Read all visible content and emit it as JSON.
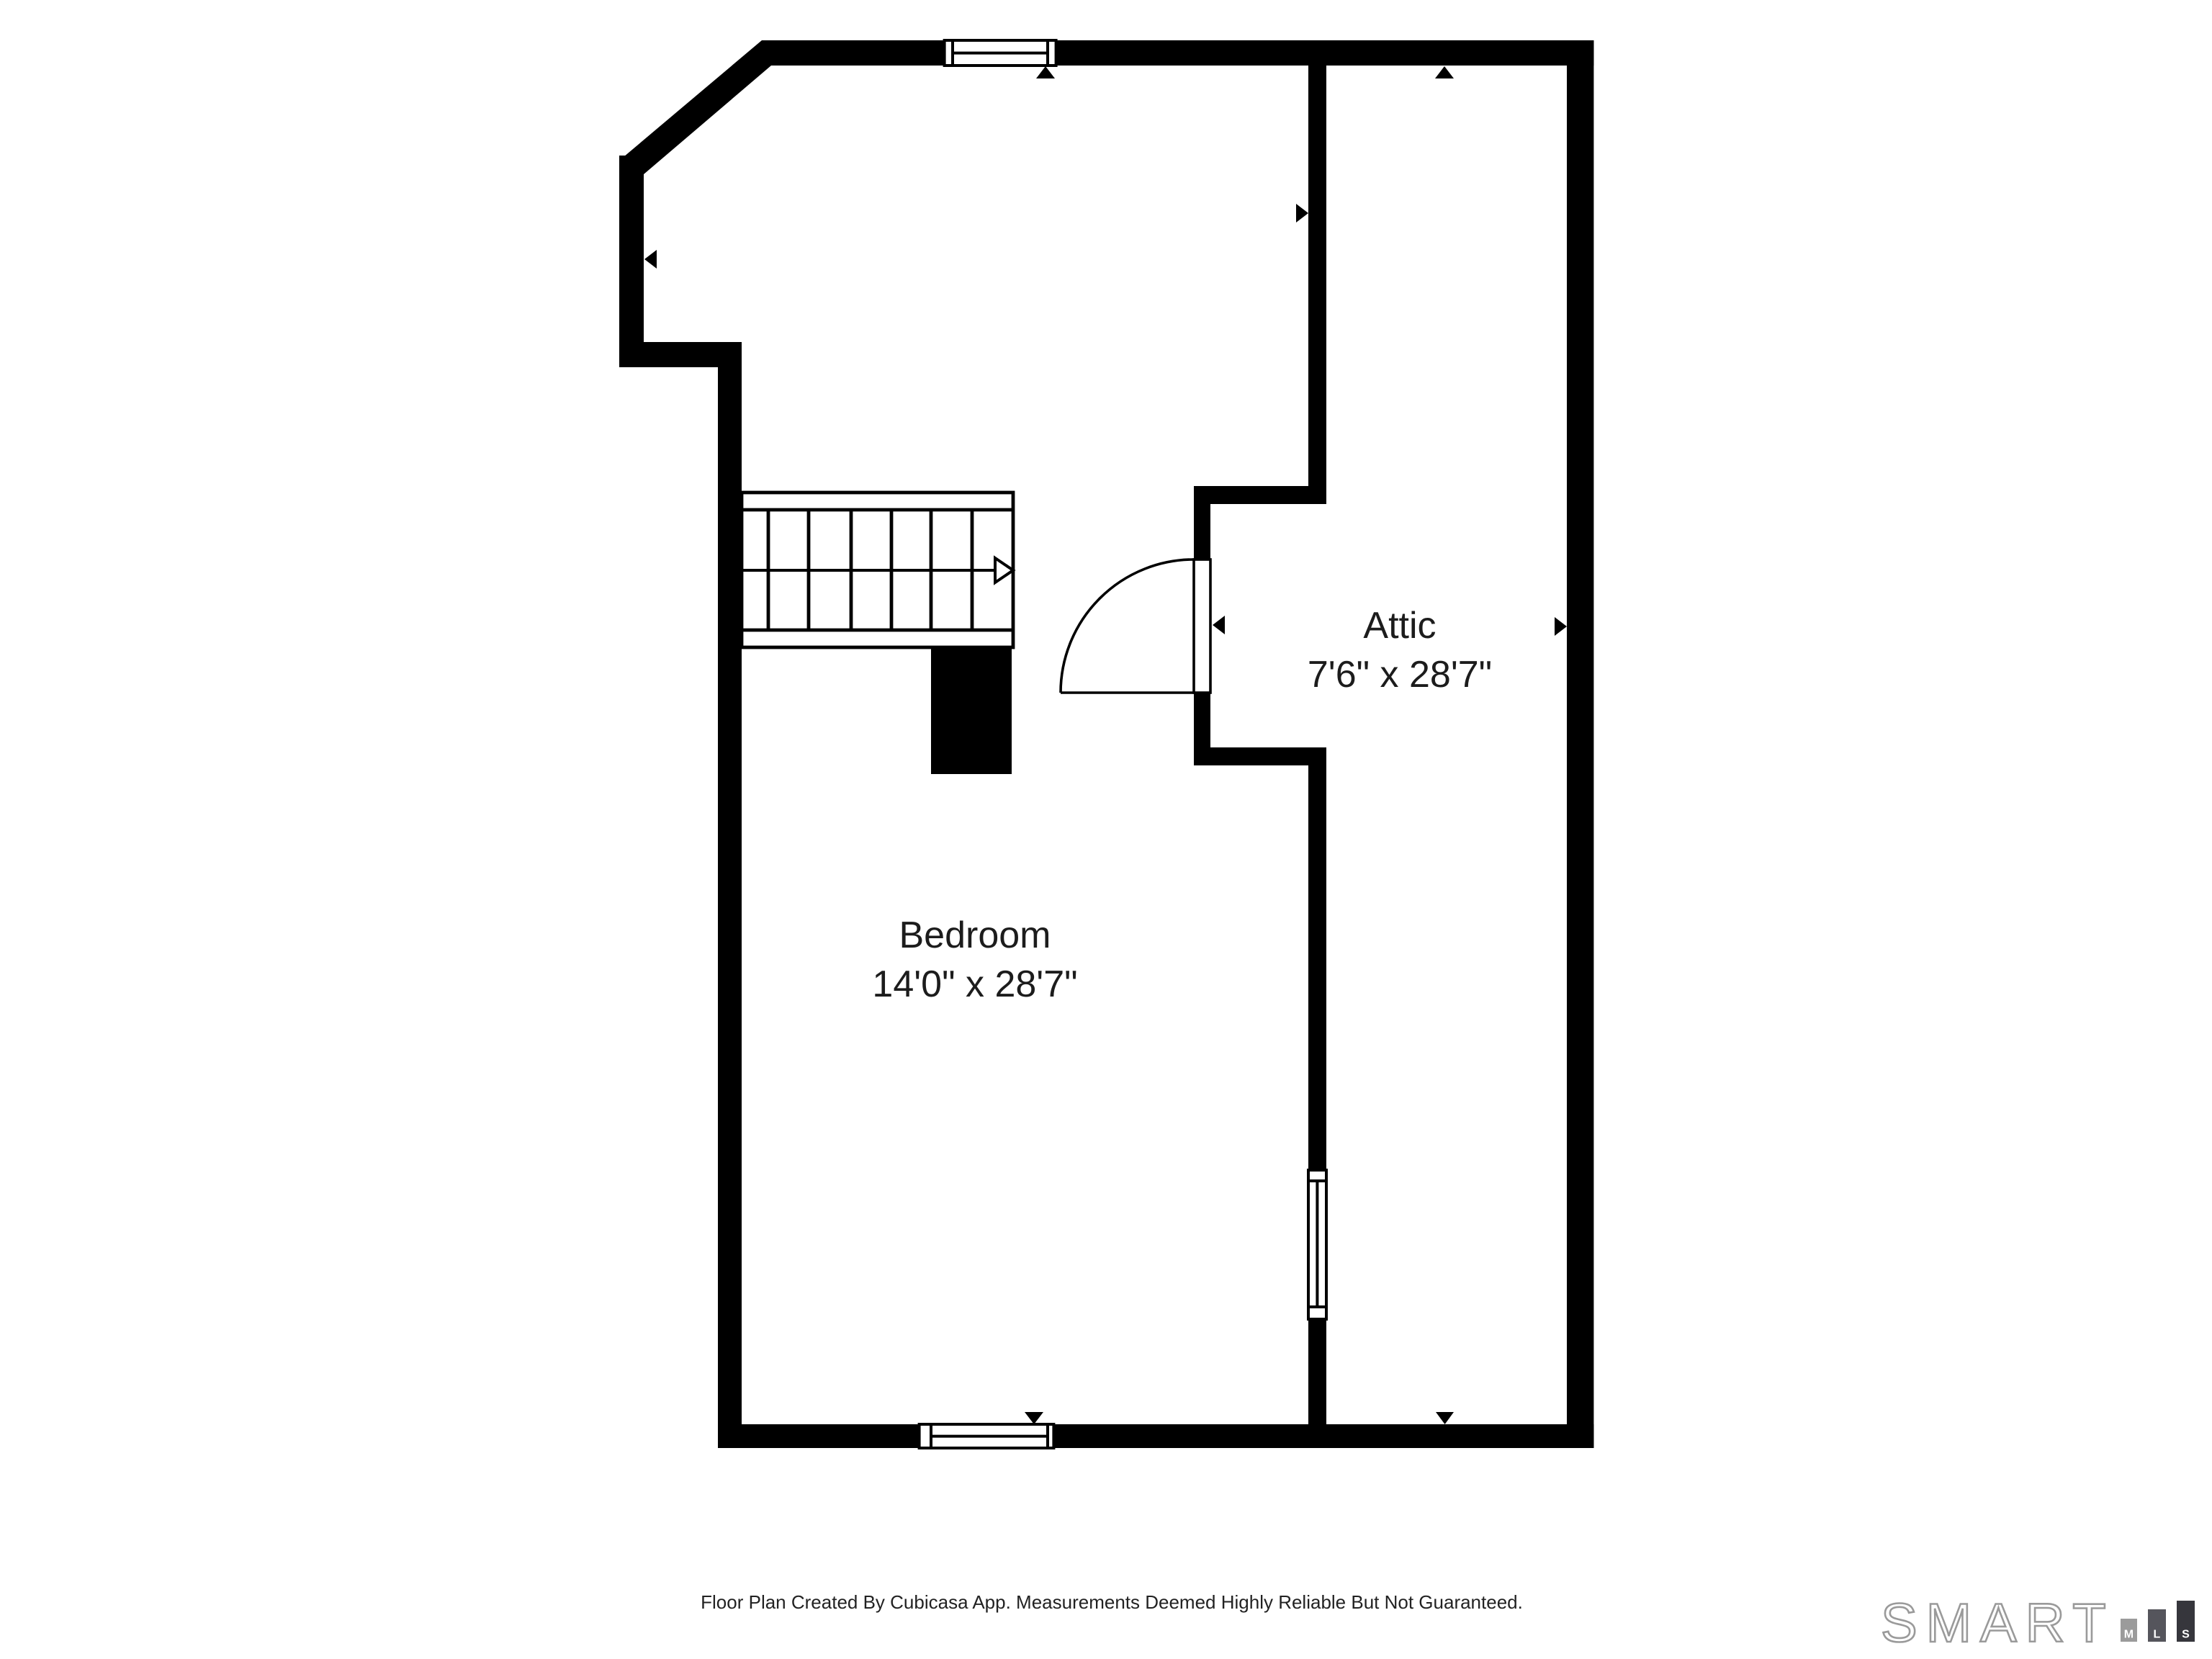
{
  "floorplan": {
    "rooms": {
      "attic": {
        "name": "Attic",
        "dimensions": "7'6\" x 28'7\""
      },
      "bedroom": {
        "name": "Bedroom",
        "dimensions": "14'0\" x 28'7\""
      }
    },
    "colors": {
      "wall": "#000000",
      "background": "#ffffff",
      "label_text": "#1c1c1c"
    }
  },
  "footer": {
    "disclaimer": "Floor Plan Created By Cubicasa App. Measurements Deemed Highly Reliable But Not Guaranteed."
  },
  "logo": {
    "brand": "SMART",
    "bars": {
      "m": {
        "letter": "M",
        "color": "#9b9b9b"
      },
      "l": {
        "letter": "L",
        "color": "#55555c"
      },
      "s": {
        "letter": "S",
        "color": "#36363c"
      }
    },
    "outline_color": "#9a9a9a"
  }
}
